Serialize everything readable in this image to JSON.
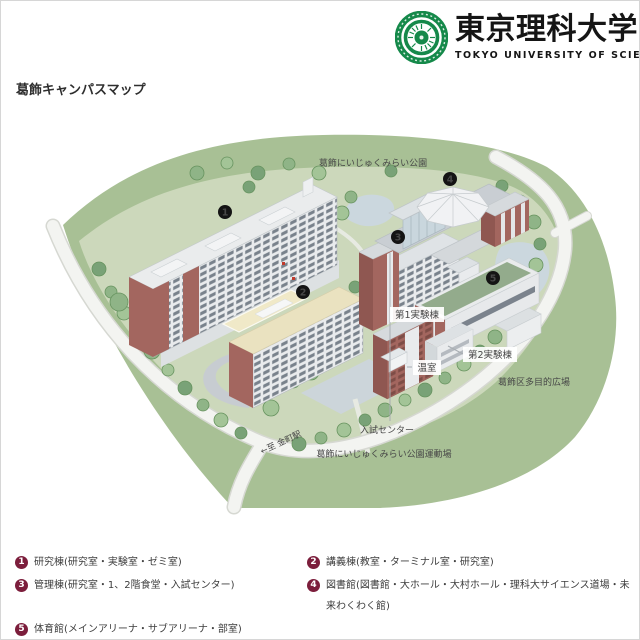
{
  "header": {
    "logo": {
      "emblem_icon": "tus-emblem",
      "title_jp": "東京理科大学",
      "subtitle_en": "TOKYO UNIVERSITY OF SCIENCE"
    },
    "page_title": "葛飾キャンパスマップ"
  },
  "map": {
    "area_labels": [
      {
        "id": "park-top",
        "text": "葛飾にいじゅくみらい公園"
      },
      {
        "id": "tamokuteki",
        "text": "葛飾区多目的広場"
      },
      {
        "id": "nyushi",
        "text": "入試センター"
      },
      {
        "id": "undojo",
        "text": "葛飾にいじゅくみらい公園運動場"
      },
      {
        "id": "station",
        "text": "←至 金町駅"
      },
      {
        "id": "jikken1",
        "text": "第1実験棟"
      },
      {
        "id": "jikken2",
        "text": "第2実験棟"
      },
      {
        "id": "onshitsu",
        "text": "温室"
      }
    ],
    "badges": [
      {
        "number": "1"
      },
      {
        "number": "2"
      },
      {
        "number": "3"
      },
      {
        "number": "4"
      },
      {
        "number": "5"
      }
    ]
  },
  "legend": {
    "items": [
      {
        "number": "1",
        "label": "研究棟(研究室・実験室・ゼミ室)"
      },
      {
        "number": "2",
        "label": "講義棟(教室・ターミナル室・研究室)"
      },
      {
        "number": "3",
        "label": "管理棟(研究室・1、2階食堂・入試センター)"
      },
      {
        "number": "4",
        "label": "図書館(図書館・大ホール・大村ホール・理科大サイエンス道場・未来わくわく館)"
      },
      {
        "number": "5",
        "label": "体育館(メインアリーナ・サブアリーナ・部室)"
      }
    ]
  },
  "colors": {
    "logo_green": "#15894a",
    "map_badge_black": "#141414",
    "legend_badge_maroon": "#7c1e3c",
    "campus_green": "#ccd8bb",
    "park_green": "#a8c095",
    "brick": "#a3665f",
    "road_white": "#f3f4f1",
    "pond_blue": "#cbd7de",
    "cream_roof": "#eae2c0",
    "gym_roof_green": "#93ab8c"
  }
}
